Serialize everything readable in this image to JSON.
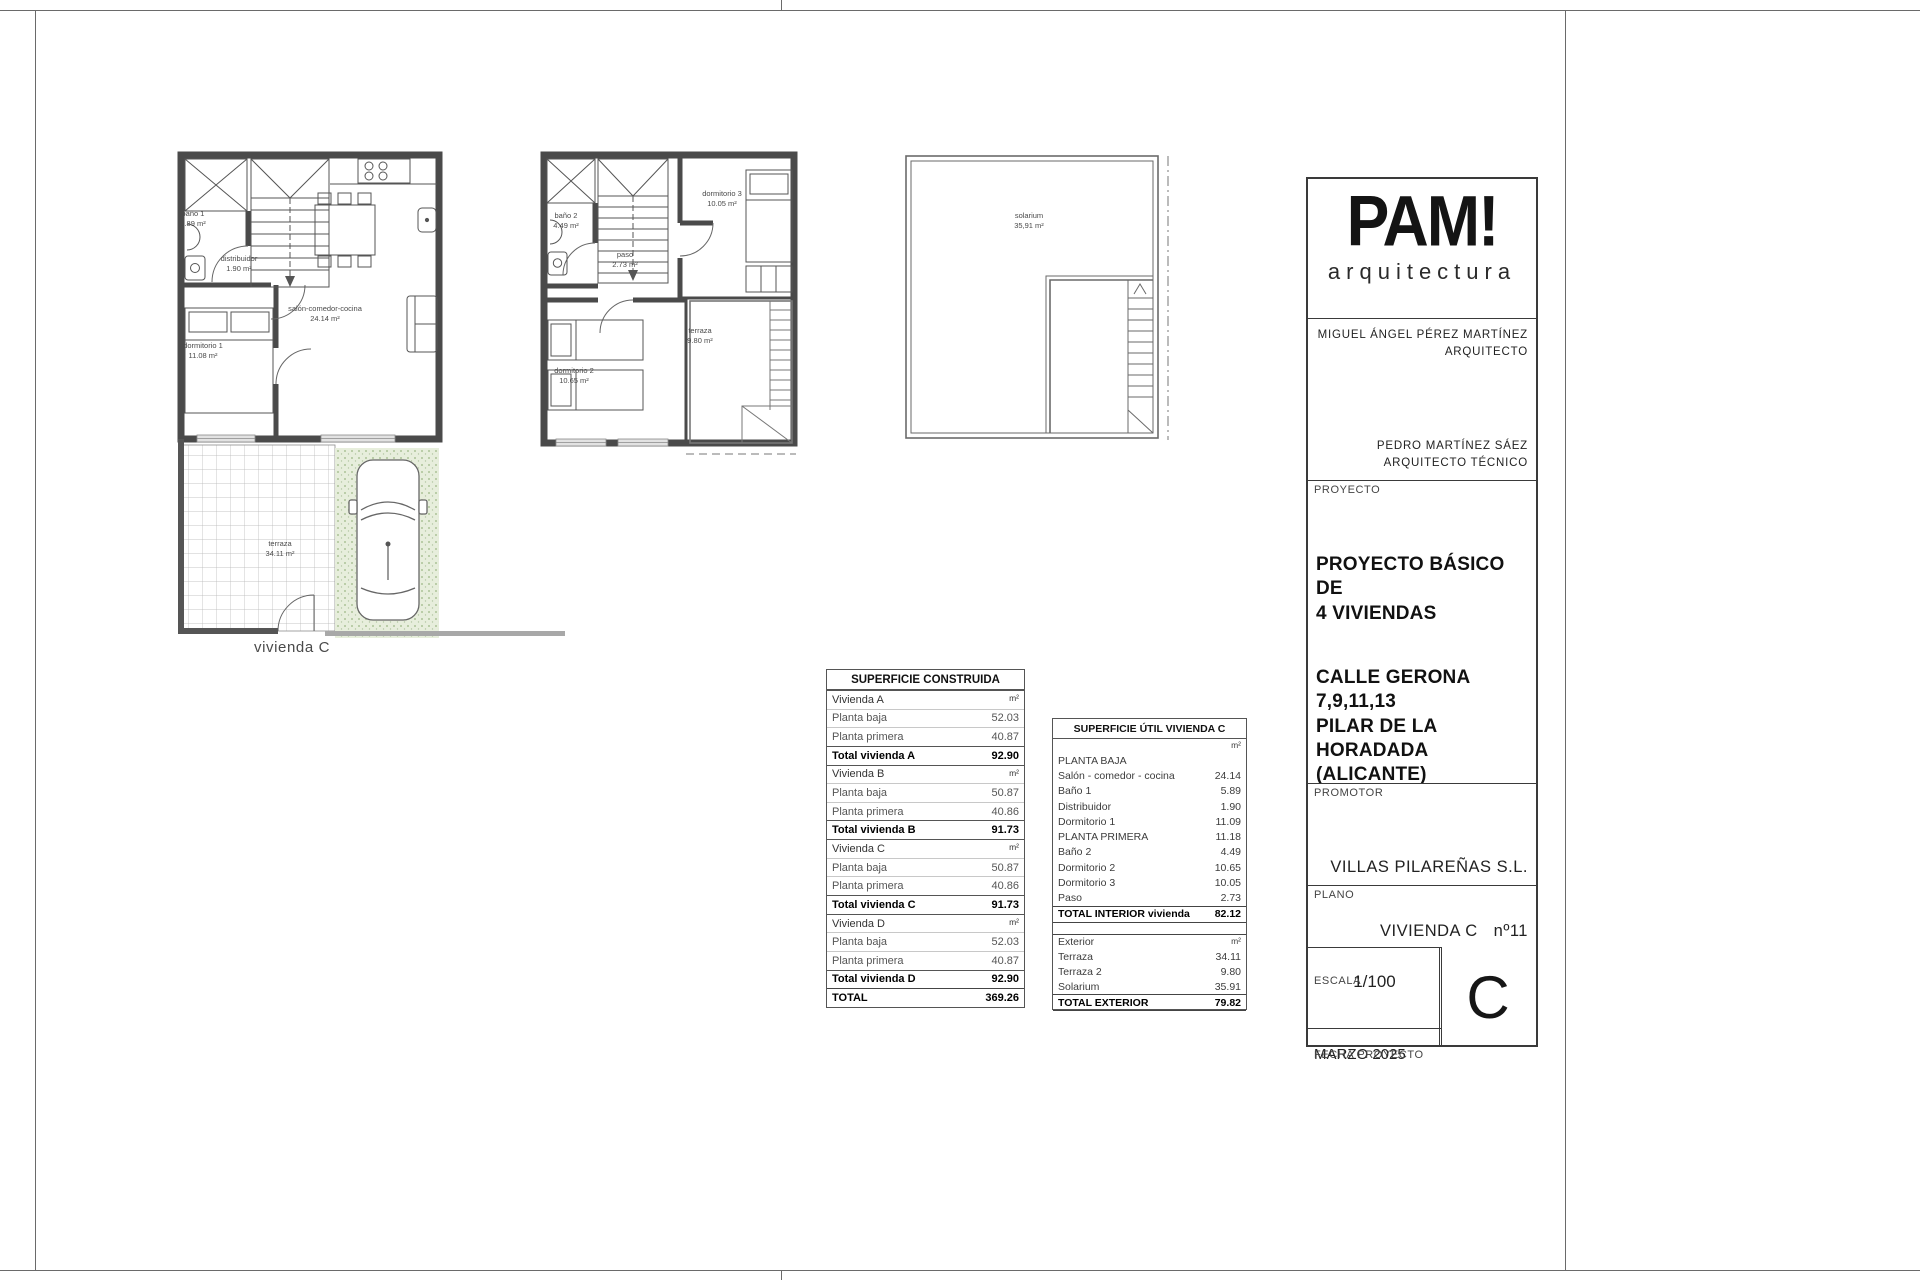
{
  "sheet": {
    "caption_ground": "vivienda C"
  },
  "plans": {
    "ground": {
      "caption": "vivienda C",
      "bano1": {
        "name": "baño 1",
        "area": "5.89 m²"
      },
      "distribuidor": {
        "name": "distribuidor",
        "area": "1.90 m²"
      },
      "salon": {
        "name": "salón-comedor-cocina",
        "area": "24.14 m²"
      },
      "dorm1": {
        "name": "dormitorio 1",
        "area": "11.08 m²"
      },
      "terraza": {
        "name": "terraza",
        "area": "34.11 m²"
      }
    },
    "first": {
      "bano2": {
        "name": "baño 2",
        "area": "4.49 m²"
      },
      "paso": {
        "name": "paso",
        "area": "2.73 m²"
      },
      "dorm3": {
        "name": "dormitorio 3",
        "area": "10.05 m²"
      },
      "dorm2": {
        "name": "dormitorio 2",
        "area": "10.65 m²"
      },
      "terraza": {
        "name": "terraza",
        "area": "9.80 m²"
      }
    },
    "solarium": {
      "solarium": {
        "name": "solarium",
        "area": "35,91 m²"
      }
    }
  },
  "tables": {
    "construida": {
      "title": "SUPERFICIE CONSTRUIDA",
      "rows": [
        {
          "label": "Vivienda A",
          "value": "m²",
          "cls": "sec"
        },
        {
          "label": "Planta baja",
          "value": "52.03",
          "cls": "item"
        },
        {
          "label": "Planta primera",
          "value": "40.87",
          "cls": "item"
        },
        {
          "label": "Total vivienda A",
          "value": "92.90",
          "cls": "total"
        },
        {
          "label": "Vivienda B",
          "value": "m²",
          "cls": "sec"
        },
        {
          "label": "Planta baja",
          "value": "50.87",
          "cls": "item"
        },
        {
          "label": "Planta primera",
          "value": "40.86",
          "cls": "item"
        },
        {
          "label": "Total vivienda B",
          "value": "91.73",
          "cls": "total"
        },
        {
          "label": "Vivienda C",
          "value": "m²",
          "cls": "sec"
        },
        {
          "label": "Planta baja",
          "value": "50.87",
          "cls": "item"
        },
        {
          "label": "Planta primera",
          "value": "40.86",
          "cls": "item"
        },
        {
          "label": "Total vivienda C",
          "value": "91.73",
          "cls": "total"
        },
        {
          "label": "Vivienda D",
          "value": "m²",
          "cls": "sec"
        },
        {
          "label": "Planta baja",
          "value": "52.03",
          "cls": "item"
        },
        {
          "label": "Planta primera",
          "value": "40.87",
          "cls": "item"
        },
        {
          "label": "Total vivienda D",
          "value": "92.90",
          "cls": "total"
        },
        {
          "label": "TOTAL",
          "value": "369.26",
          "cls": "grand"
        }
      ]
    },
    "util": {
      "title": "SUPERFICIE ÚTIL VIVIENDA C",
      "interior_rows": [
        {
          "label": "",
          "value": "m²",
          "cls": "unit"
        },
        {
          "label": "PLANTA BAJA",
          "value": "",
          "cls": "plain"
        },
        {
          "label": "Salón - comedor - cocina",
          "value": "24.14",
          "cls": "plain"
        },
        {
          "label": "Baño 1",
          "value": "5.89",
          "cls": "plain"
        },
        {
          "label": "Distribuidor",
          "value": "1.90",
          "cls": "plain"
        },
        {
          "label": "Dormitorio 1",
          "value": "11.09",
          "cls": "plain"
        },
        {
          "label": "PLANTA PRIMERA",
          "value": "11.18",
          "cls": "plain"
        },
        {
          "label": "Baño 2",
          "value": "4.49",
          "cls": "plain"
        },
        {
          "label": "Dormitorio 2",
          "value": "10.65",
          "cls": "plain"
        },
        {
          "label": "Dormitorio 3",
          "value": "10.05",
          "cls": "plain"
        },
        {
          "label": "Paso",
          "value": "2.73",
          "cls": "plain"
        },
        {
          "label": "TOTAL INTERIOR vivienda",
          "value": "82.12",
          "cls": "total"
        }
      ],
      "exterior_rows": [
        {
          "label": "Exterior",
          "value": "m²",
          "cls": "exthead"
        },
        {
          "label": "Terraza",
          "value": "34.11",
          "cls": "plain"
        },
        {
          "label": "Terraza 2",
          "value": "9.80",
          "cls": "plain"
        },
        {
          "label": "Solarium",
          "value": "35.91",
          "cls": "plain"
        },
        {
          "label": "TOTAL EXTERIOR",
          "value": "79.82",
          "cls": "total"
        }
      ]
    }
  },
  "titleblock": {
    "logo_text": "PAM!",
    "logo_subtext": "arquitectura",
    "architect_1_name": "MIGUEL ÁNGEL PÉREZ MARTÍNEZ",
    "architect_1_role": "ARQUITECTO",
    "architect_2_name": "PEDRO MARTÍNEZ SÁEZ",
    "architect_2_role": "ARQUITECTO TÉCNICO",
    "proyecto_label": "PROYECTO",
    "proyecto_title": "PROYECTO BÁSICO DE\n4 VIVIENDAS",
    "proyecto_address": "CALLE GERONA\n7,9,11,13\nPILAR DE LA HORADADA\n(ALICANTE)",
    "promotor_label": "PROMOTOR",
    "promotor_value": "VILLAS PILAREÑAS S.L.",
    "plano_label": "PLANO",
    "plano_value": "VIVIENDA C",
    "plano_number": "nº11",
    "escala_label": "ESCALA",
    "escala_value": "1/100",
    "fecha_label": "FECHA PROYECTO",
    "fecha_value": "MARZO 2025",
    "sheet_letter": "C"
  }
}
